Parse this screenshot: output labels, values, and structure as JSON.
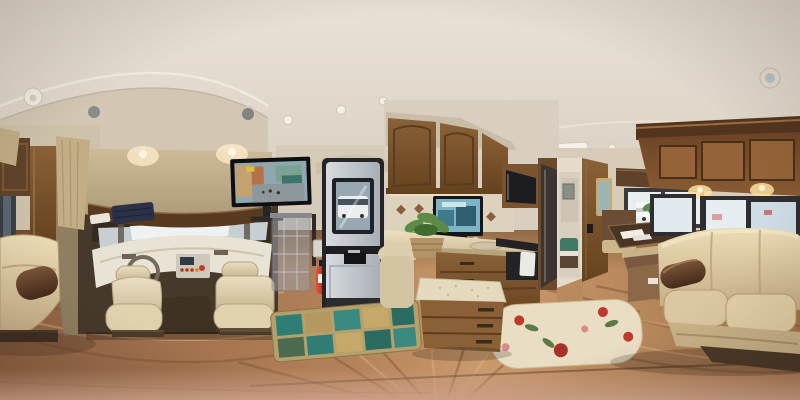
{
  "scene": {
    "type": "equirectangular-360-panorama",
    "subject": "Class C motorhome (RV) interior",
    "description": "360-degree panoramic photo inside an RV: cream leather cab seats, dashboard and a wall TV below the cab-over bunk on the left; a silver entry door, hanging shoe organizer, fire extinguisher and galley kitchen with wood cabinets in the center; a dinette booth, rear-bedroom hallway and cream leather sofa under tinted windows on the right; warm wood-plank flooring warped by the panorama with a teal patchwork rug and a cream floral rug.",
    "regions": {
      "ceiling": {
        "label": "Curved cream ceiling with seam arches"
      },
      "ceiling_lights": {
        "label": "Recessed ceiling lights"
      },
      "ceiling_speakers": {
        "label": "Round ceiling speakers"
      },
      "smoke_detector": {
        "label": "Round white detector on ceiling"
      },
      "ac_vent": {
        "label": "White air-conditioning ceiling vent"
      },
      "front_cap": {
        "label": "Front cap arch over the cab"
      },
      "cab": {
        "label": "Driving cab recess"
      },
      "windshield": {
        "label": "Bright windshield band"
      },
      "dashboard": {
        "label": "Cream dashboard cover with radio stack"
      },
      "steering_wheel": {
        "label": "Steering wheel"
      },
      "driver_seat": {
        "label": "Beige leather driver seat"
      },
      "passenger_seat": {
        "label": "Beige leather passenger seat"
      },
      "cabover_bunk": {
        "label": "Tan upholstered cab-over bunk with navy bedding"
      },
      "tv": {
        "label": "Wall-mounted TV playing a street scene"
      },
      "shoe_organizer": {
        "label": "Clear hanging pocket organizer behind passenger seat"
      },
      "fire_extinguisher": {
        "label": "Red fire extinguisher beside entry door"
      },
      "entry_door": {
        "label": "Silver entry door with black frame"
      },
      "door_window": {
        "label": "Door window with white RV visible outside"
      },
      "teal_rug": {
        "label": "Teal patchwork rug at the entry"
      },
      "kitchen_cabinets": {
        "label": "Overhead wood kitchen cabinets"
      },
      "backsplash": {
        "label": "Tile backsplash with diamond accents"
      },
      "counter_tv": {
        "label": "Small TV standing on the counter"
      },
      "kitchen_counter": {
        "label": "Cream kitchen countertop with sink and faucet"
      },
      "plant_basket": {
        "label": "Green plant in a wicker basket on the counter"
      },
      "microwave": {
        "label": "Built-in microwave"
      },
      "stove": {
        "label": "Black cooktop and oven with white towel"
      },
      "refrigerator": {
        "label": "Dark paneled refrigerator"
      },
      "hallway": {
        "label": "Hallway to the rear bedroom"
      },
      "bedroom": {
        "label": "Rear bedroom with teal bedding"
      },
      "wall_mirror": {
        "label": "Framed mirror on dinette pillar"
      },
      "dinette": {
        "label": "Booth dinette with brown-and-tan cushions"
      },
      "dinette_table": {
        "label": "Dark wood dinette table with papers and plant"
      },
      "dinette_window": {
        "label": "Dinette window with vehicle outside"
      },
      "floral_rug": {
        "label": "Cream floral area rug"
      },
      "storage_ottoman": {
        "label": "Upholstered ottoman island with wood drawers"
      },
      "overhead_cabinets": {
        "label": "Overhead wood cabinets with puck lights above sofa"
      },
      "sofa_windows": {
        "label": "Tinted slider windows behind the sofa"
      },
      "sofa": {
        "label": "Cream leather sofa with brown armrest"
      },
      "left_sofa_section": {
        "label": "Left wrap of the same sofa (panorama seam)"
      },
      "curtains": {
        "label": "Tan curtains at left window"
      },
      "left_window": {
        "label": "Dark window at far left"
      },
      "wood_floor": {
        "label": "Warped wood-plank flooring"
      },
      "nadir_blur": {
        "label": "Blurred nadir strip at bottom of panorama"
      }
    }
  },
  "palette": {
    "ceiling_light": "#e8e1d6",
    "ceiling_shade": "#d5ccbe",
    "wall_cream": "#cfc2ab",
    "cap_tan": "#d3c6b3",
    "bunk_tan": "#c7b493",
    "navy_bedding": "#2b3147",
    "wood_dark": "#5e4026",
    "wood_mid": "#7d5835",
    "cabinet_face": "#8a6138",
    "floor_base": "#b5835a",
    "floor_dark": "#8a5f3e",
    "nadir_pink": "#cf9f82",
    "leather_cream": "#dfcda8",
    "leather_brown": "#5f4530",
    "door_silver": "#c6cacf",
    "door_frame": "#2a2a2c",
    "glass_bright": "#eef2f4",
    "extinguisher_red": "#c0392b",
    "rug_teal": "#2f7d74",
    "rug_cream": "#e9ddc4",
    "plant_green": "#4a7d3a",
    "counter_cream": "#ded0b2"
  }
}
